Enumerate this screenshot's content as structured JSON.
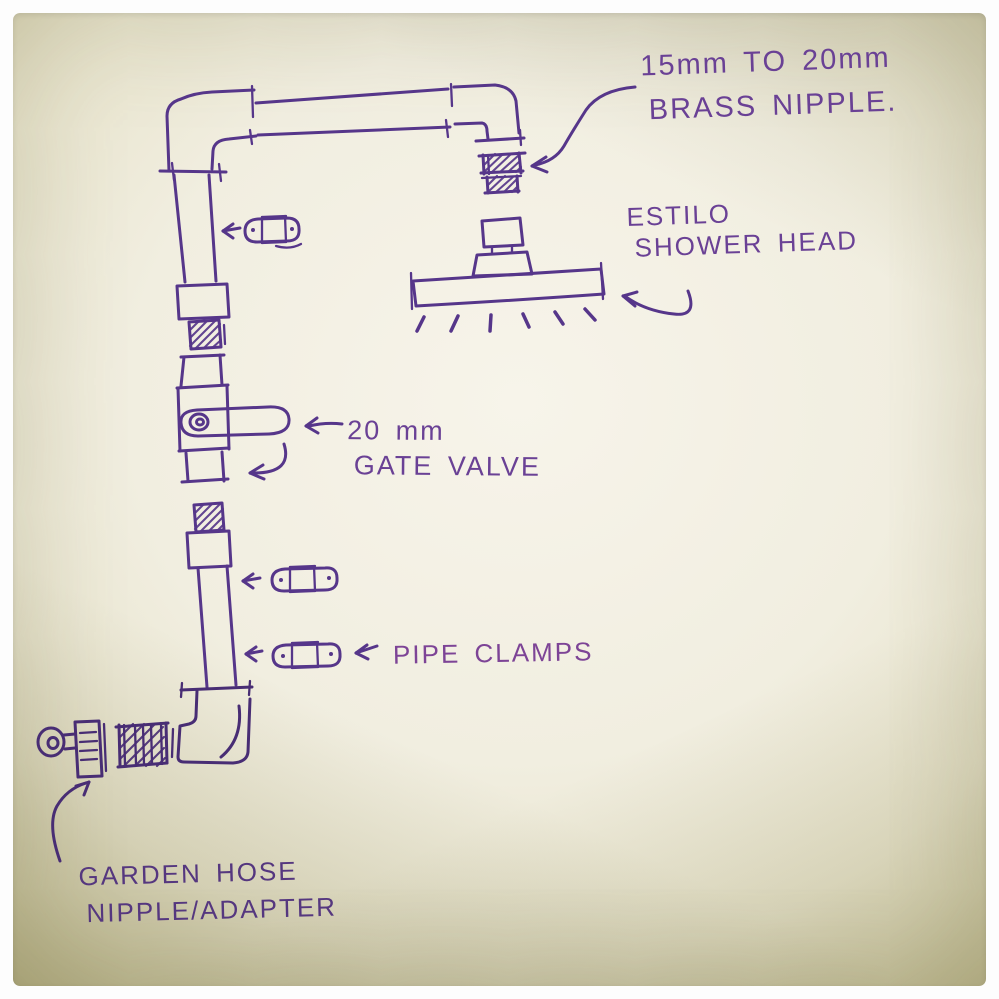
{
  "annotations": {
    "brass_nipple": {
      "line1": "15mm TO 20mm",
      "line2": "BRASS NIPPLE."
    },
    "shower_head": {
      "line1": "ESTILO",
      "line2": "SHOWER HEAD"
    },
    "gate_valve": {
      "line1": "20 mm",
      "line2": "GATE VALVE"
    },
    "pipe_clamps": {
      "label": "PIPE CLAMPS"
    },
    "garden_hose": {
      "line1": "GARDEN HOSE",
      "line2": "NIPPLE/ADAPTER"
    }
  },
  "sketch_components": [
    "top-left-elbow",
    "top-horizontal-pipe",
    "top-right-elbow",
    "brass-nipple-15-to-20mm",
    "estilo-shower-head",
    "spray-dashes",
    "pipe-clamp-1",
    "pipe-clamp-2",
    "pipe-clamp-3",
    "upper-wall-pipe-with-coupling-and-thread",
    "20mm-gate-valve-with-lever",
    "lower-wall-pipe-with-coupling-and-thread",
    "bottom-elbow",
    "bottom-brass-nipple",
    "garden-hose-nipple-adapter",
    "annotation-arrows"
  ],
  "colors": {
    "ink": "#56368a",
    "ink_dark": "#482d74",
    "ink_text": "#6a4195",
    "paper_center": "#f6f3e9",
    "paper_edge": "#b9b480",
    "frame": "#fdfdfd"
  }
}
